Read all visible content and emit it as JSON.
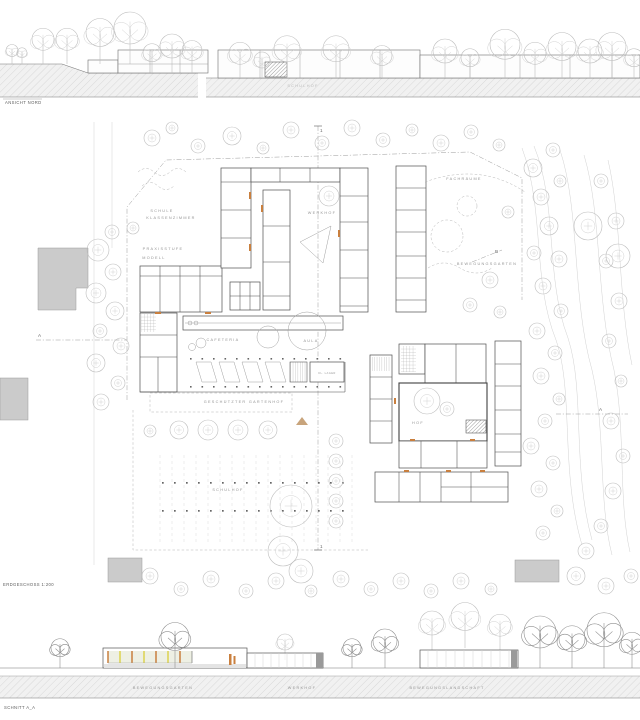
{
  "drawing": {
    "elevation": {
      "title": "ANSICHT NORD",
      "annotation": "SCHULHOF"
    },
    "plan": {
      "title": "ERDGESCHOSS 1:200",
      "areas": {
        "schule_line1": "SCHULE",
        "schule_line2": "KLASSENZIMMER",
        "praxisstufe": "PRAXISSTUFE",
        "modell": "MODELL",
        "werkhof": "WERKHOF",
        "fachraeume": "FACHRÄUME",
        "bewegungsgarten": "BEWEGUNGSGARTEN",
        "cafeteria": "CAFETERIA",
        "aula": "AULA",
        "gartenhof": "GESCHÜTZTER GARTENHOF",
        "schulhof": "SCHULHOF",
        "hof": "HOF",
        "kl_lager": "KL. LAGER"
      },
      "markers": {
        "a": "A",
        "b": "B",
        "one": "1"
      }
    },
    "section": {
      "title": "SCHNITT A_A",
      "areas": {
        "bewegungsgarten": "BEWEGUNGSGARTEN",
        "werkhof": "WERKHOF",
        "bewegungslandschaft": "BEWEGUNGSLANDSCHAFT"
      }
    },
    "colors": {
      "line": "#4f4f4f",
      "tree": "#bdbdbd",
      "ground_hatch": "#d8d8d8",
      "context_fill": "#cbcbcb",
      "accent_orange": "#c97f3e",
      "accent_tan": "#c8a47c",
      "glass_yellow": "#ddd24f"
    }
  }
}
